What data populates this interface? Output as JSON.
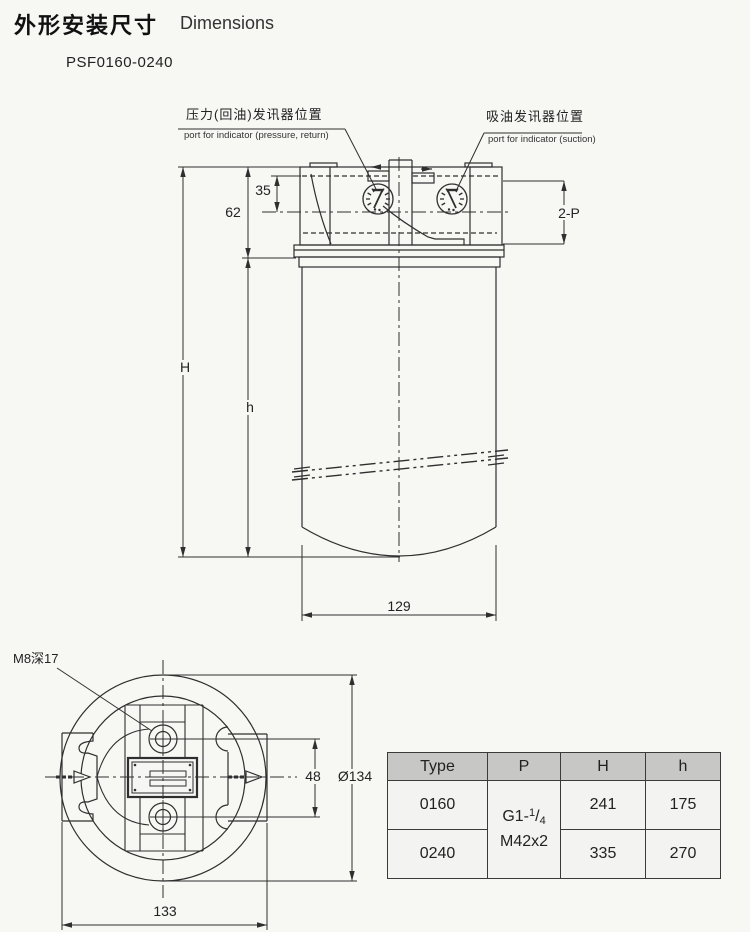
{
  "title": {
    "zh": "外形安装尺寸",
    "en": "Dimensions",
    "model": "PSF0160-0240"
  },
  "port_labels": {
    "pressure_zh": "压力(回油)发讯器位置",
    "pressure_en": "port for indicator (pressure, return)",
    "suction_zh": "吸油发讯器位置",
    "suction_en": "port for indicator (suction)"
  },
  "dims": {
    "d35": "35",
    "d62": "62",
    "H": "H",
    "h": "h",
    "p2": "2-P",
    "d129": "129",
    "m8": "M8深17",
    "d48": "48",
    "d134": "Ø134",
    "d133": "133"
  },
  "table": {
    "headers": [
      "Type",
      "P",
      "H",
      "h"
    ],
    "p_cell": {
      "base": "G1-",
      "sup": "1",
      "slash": "/",
      "sub": "4",
      "line2": "M42x2"
    },
    "rows": [
      {
        "type": "0160",
        "H": "241",
        "h": "175"
      },
      {
        "type": "0240",
        "H": "335",
        "h": "270"
      }
    ]
  }
}
